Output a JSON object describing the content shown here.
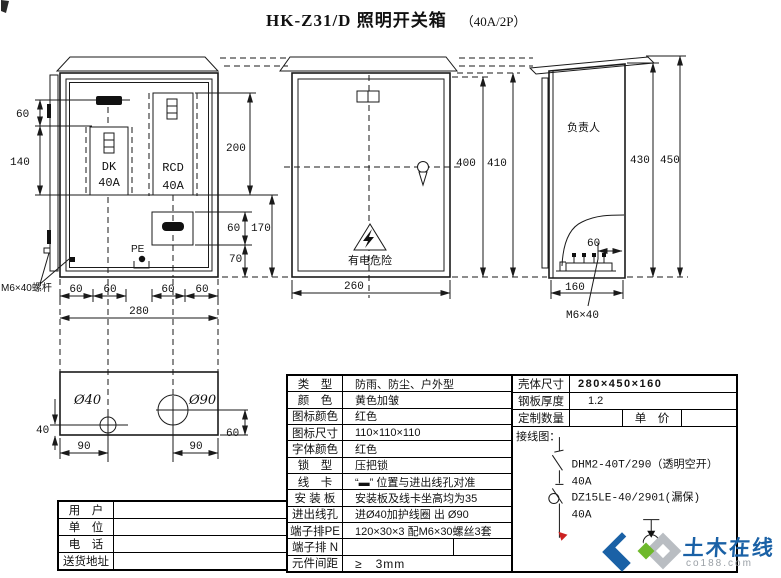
{
  "title": {
    "main": "HK-Z31/D 照明开关箱",
    "suffix": "（40A/2P）"
  },
  "front_view": {
    "breaker_dk_name": "DK",
    "breaker_dk_amp": "40A",
    "breaker_rcd_name": "RCD",
    "breaker_rcd_amp": "40A",
    "pe_label": "PE",
    "bolt_label": "M6×40螺杆",
    "dim_60_left": "60",
    "dim_140": "140",
    "dim_200": "200",
    "dim_60_right": "60",
    "dim_170": "170",
    "dim_70": "70",
    "dims_bottom": [
      "60",
      "60",
      "60",
      "60"
    ],
    "dim_280": "280"
  },
  "center_view": {
    "warning": "有电危险",
    "dim_400": "400",
    "dim_410": "410",
    "dim_260": "260"
  },
  "side_view": {
    "person": "负责人",
    "dim_430": "430",
    "dim_450": "450",
    "dim_60": "60",
    "dim_160": "160",
    "bolt_label": "M6×40"
  },
  "bottom_view": {
    "hole_small": "Ø40",
    "hole_big": "Ø90",
    "dim_40": "40",
    "dim_60": "60",
    "dim_90_left": "90",
    "dim_90_right": "90"
  },
  "spec_table": {
    "rows": [
      {
        "label": "类　型",
        "value": "防雨、防尘、户外型"
      },
      {
        "label": "颜　色",
        "value": "黄色加皱"
      },
      {
        "label": "图标颜色",
        "value": "红色"
      },
      {
        "label": "图标尺寸",
        "value": "110×110×110"
      },
      {
        "label": "字体颜色",
        "value": "红色"
      },
      {
        "label": "锁　型",
        "value": "压把锁"
      },
      {
        "label": "线　卡",
        "value": "“▬” 位置与进出线孔对准"
      },
      {
        "label": "安 装 板",
        "value": "安装板及线卡坐高均为35"
      },
      {
        "label": "进出线孔",
        "value": "进Ø40加护线圈 出 Ø90"
      },
      {
        "label": "端子排PE",
        "value": "120×30×3 配M6×30螺丝3套"
      },
      {
        "label": "端子排 N",
        "value": ""
      },
      {
        "label": "元件间距",
        "value": "≥　3mm"
      }
    ]
  },
  "info_table": {
    "shell_label": "壳体尺寸",
    "shell_value": "280×450×160",
    "steel_label": "钢板厚度",
    "steel_value": "1.2",
    "qty_label": "定制数量",
    "qty_value": "",
    "price_label": "单　价",
    "price_value": ""
  },
  "order_table": {
    "rows": [
      {
        "label": "用　户",
        "value": ""
      },
      {
        "label": "单　位",
        "value": ""
      },
      {
        "label": "电　话",
        "value": ""
      },
      {
        "label": "送货地址",
        "value": ""
      }
    ]
  },
  "wiring": {
    "title": "接线图：",
    "breaker1_model": "DHM2-40T/290（透明空开）",
    "breaker1_amp": "40A",
    "breaker2_model": "DZ15LE-40/2901(漏保)",
    "breaker2_amp": "40A"
  },
  "watermark": {
    "name": "土木在线",
    "domain": "co188.com"
  },
  "colors": {
    "line": "#1a1a1a",
    "accent_red": "#cc2222",
    "wm_blue": "#1a61a6",
    "wm_green": "#6fb92c",
    "wm_gray": "#b9bdc2"
  }
}
